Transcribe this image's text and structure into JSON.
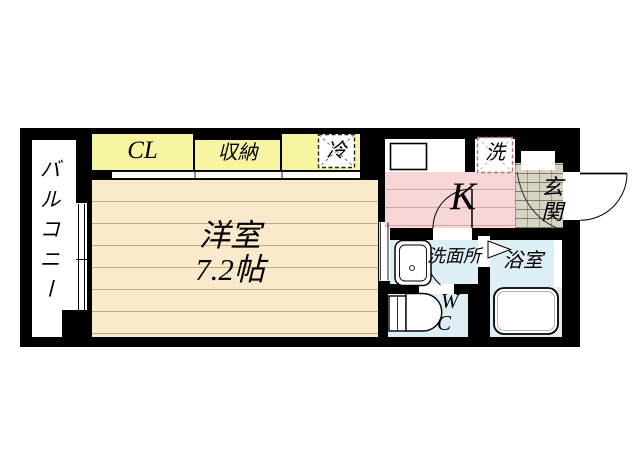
{
  "meta": {
    "type": "floorplan",
    "description": "1K apartment floor plan"
  },
  "labels": {
    "balcony": "バルコニー",
    "closet": "CL",
    "storage": "収納",
    "refrigerator": "冷",
    "laundry": "洗",
    "kitchen": "K",
    "entrance": "玄関",
    "main_room_name": "洋室",
    "main_room_size": "7.2帖",
    "washroom": "洗面所",
    "bathroom": "浴室",
    "toilet_line1": "W",
    "toilet_line2": "C"
  },
  "colors": {
    "wall": "#000000",
    "closet_yellow": "#f7f5a1",
    "room_cream": "#faeacc",
    "room_line": "#c9a87c",
    "kitchen_pink": "#f7d6d8",
    "kitchen_line": "#d5a5a5",
    "wet_area_blue": "#ddeef5",
    "entrance_tile": "#d8d4c4",
    "laundry_dash": "#c46a6a"
  }
}
